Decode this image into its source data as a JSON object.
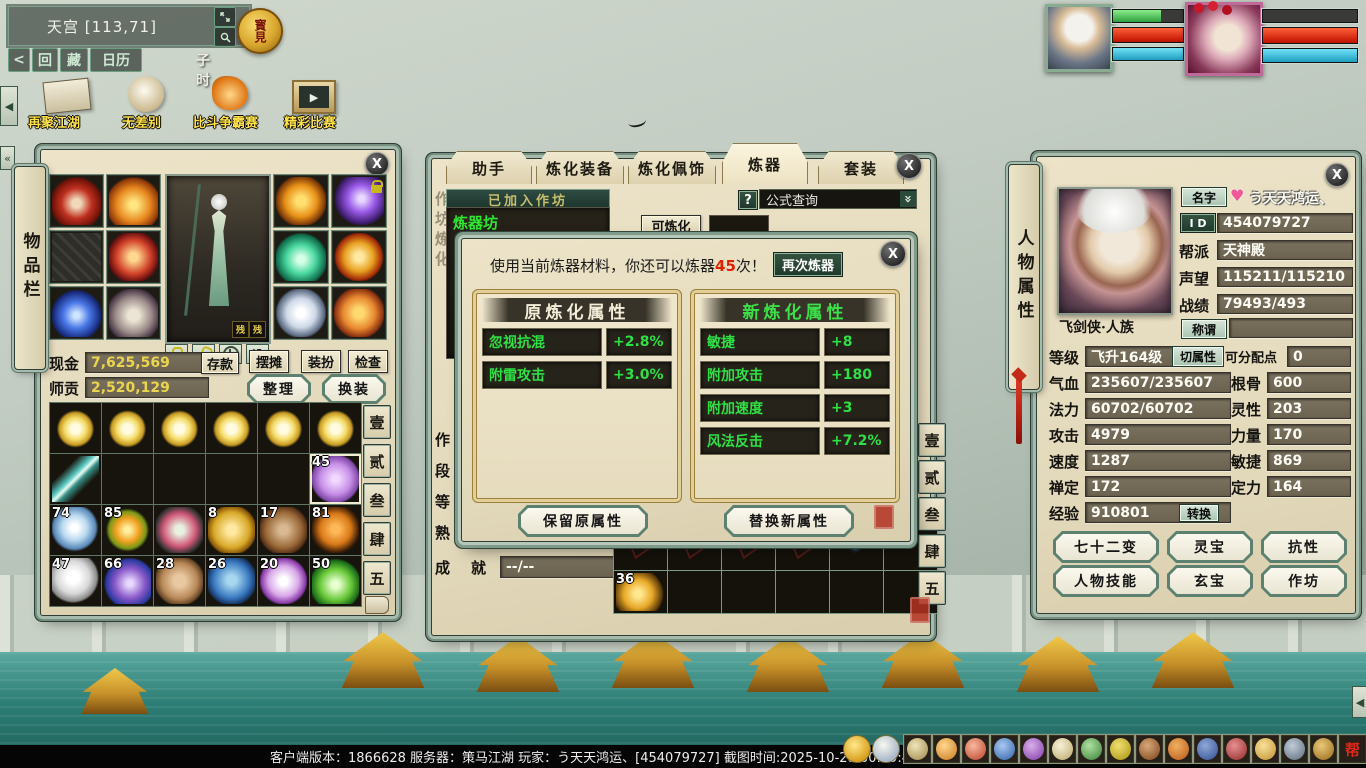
{
  "icons": {
    "close": "X",
    "heart": "♥",
    "chevron": "»",
    "play": "▶",
    "left_arrow": "◀",
    "double_left": "«"
  },
  "hud": {
    "location": "天宫 [113,71]",
    "time": "子时",
    "back_button": "<",
    "hui_button": "回",
    "cang_button": "藏",
    "calendar_button": "日历",
    "treasure_icon": "寳見",
    "activities": [
      {
        "label": "再聚江湖"
      },
      {
        "label": "无差别"
      },
      {
        "label": "比斗争霸赛"
      },
      {
        "label": "精彩比赛"
      }
    ],
    "hotbar_last": "帮",
    "statusbar": "客户端版本：1866628  服务器：策马江湖  玩家：う天天鸿运、[454079727]  截图时间:2025-10-28 00:49:48"
  },
  "unit_frames": [
    {
      "bars": [
        {
          "name": "hp-green",
          "pct": 68
        },
        {
          "name": "red",
          "pct": 100
        },
        {
          "name": "cyan",
          "pct": 100
        }
      ]
    },
    {
      "bars": [
        {
          "name": "empty",
          "pct": 0
        },
        {
          "name": "red",
          "pct": 100
        },
        {
          "name": "cyan",
          "pct": 100
        }
      ]
    }
  ],
  "inventory": {
    "title": "物品栏",
    "cash_label": "现金",
    "cash_value": "7,625,569",
    "deposit_button": "存款",
    "tribute_label": "师贡",
    "tribute_value": "2,520,129",
    "stall_button": "摆摊",
    "dress_button": "装扮",
    "inspect_button": "检查",
    "sort_button": "整理",
    "outfit_button": "换装",
    "settings_button": "设",
    "preview_badges": [
      "残",
      "残"
    ],
    "side_tabs": [
      "壹",
      "贰",
      "叁",
      "肆",
      "五"
    ],
    "counts": {
      "r2c6": "45",
      "r3c1": "74",
      "r3c2": "85",
      "r3c4": "8",
      "r3c5": "17",
      "r3c6": "81",
      "r4c1": "47",
      "r4c2": "66",
      "r4c3": "28",
      "r4c4": "26",
      "r4c5": "20",
      "r4c6": "50"
    }
  },
  "workshop": {
    "tabs": [
      "助手",
      "炼化装备",
      "炼化佩饰",
      "炼器",
      "套装"
    ],
    "active_tab": "炼器",
    "joined_header": "已加入作坊",
    "workshop_name": "炼器坊",
    "help_button": "?",
    "formula_query": "公式查询",
    "craftable_button": "可炼化",
    "side_label": "作坊炼化",
    "row_labels": [
      "作",
      "段",
      "等",
      "熟"
    ],
    "achieve_label_1": "成",
    "achieve_label_2": "就",
    "achieve_value": "--/--",
    "material_count": "36",
    "side_tabs": [
      "壹",
      "贰",
      "叁",
      "肆",
      "五"
    ]
  },
  "refine_dialog": {
    "message_pre": "使用当前炼器材料，你还可以炼器",
    "message_count": "45",
    "message_post": "次！",
    "again_button": "再次炼器",
    "old_panel": {
      "title": "原炼化属性",
      "rows": [
        {
          "name": "忽视抗混",
          "value": "+2.8%"
        },
        {
          "name": "附雷攻击",
          "value": "+3.0%"
        }
      ]
    },
    "new_panel": {
      "title": "新炼化属性",
      "rows": [
        {
          "name": "敏捷",
          "value": "+8"
        },
        {
          "name": "附加攻击",
          "value": "+180"
        },
        {
          "name": "附加速度",
          "value": "+3"
        },
        {
          "name": "风法反击",
          "value": "+7.2%"
        }
      ]
    },
    "keep_button": "保留原属性",
    "replace_button": "替换新属性"
  },
  "character": {
    "title": "人物属性",
    "name_label": "名字",
    "name_value": "う天天鸿运、",
    "id_label": "I D",
    "id_value": "454079727",
    "guild_label": "帮派",
    "guild_value": "天神殿",
    "fame_label": "声望",
    "fame_value": "115211/115210",
    "record_label": "战绩",
    "record_value": "79493/493",
    "class_race": "飞剑侠·人族",
    "alias_label": "称谓",
    "alias_value": "",
    "level_label": "等级",
    "level_value": "飞升164级",
    "switch_button": "切属性",
    "points_label": "可分配点",
    "points_value": "0",
    "hp_label": "气血",
    "hp_value": "235607/235607",
    "mp_label": "法力",
    "mp_value": "60702/60702",
    "atk_label": "攻击",
    "atk_value": "4979",
    "spd_label": "速度",
    "spd_value": "1287",
    "zen_label": "禅定",
    "zen_value": "172",
    "exp_label": "经验",
    "exp_value": "910801",
    "convert_button": "转换",
    "root_label": "根骨",
    "root_value": "600",
    "spirit_label": "灵性",
    "spirit_value": "203",
    "str_label": "力量",
    "str_value": "170",
    "agi_label": "敏捷",
    "agi_value": "869",
    "focus_label": "定力",
    "focus_value": "164",
    "buttons": [
      "七十二变",
      "灵宝",
      "抗性",
      "人物技能",
      "玄宝",
      "作坊"
    ]
  },
  "colors": {
    "accent_green": "#2ce82c",
    "value_green": "#2fe044",
    "money_yellow": "#ecd54e",
    "alert_red": "#e02000"
  }
}
